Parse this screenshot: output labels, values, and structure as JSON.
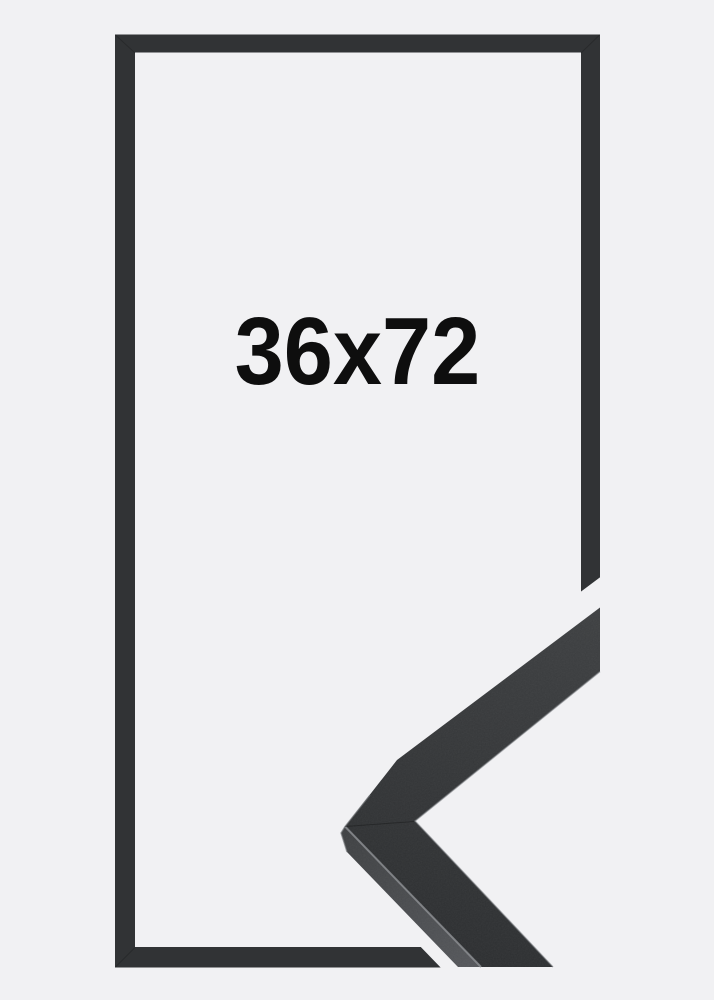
{
  "size_label": {
    "text": "36x72"
  },
  "colors": {
    "background": "#f1f1f3",
    "frame_outline": "#313335",
    "moulding_top_light": "#3f4143",
    "moulding_top_dark": "#2b2d2f",
    "moulding_side_light": "#3c3e41",
    "moulding_side_dark": "#56585c",
    "seam_highlight": "#8d9093",
    "edge_highlight": "#75787b",
    "label_text": "#0e0e0e"
  }
}
